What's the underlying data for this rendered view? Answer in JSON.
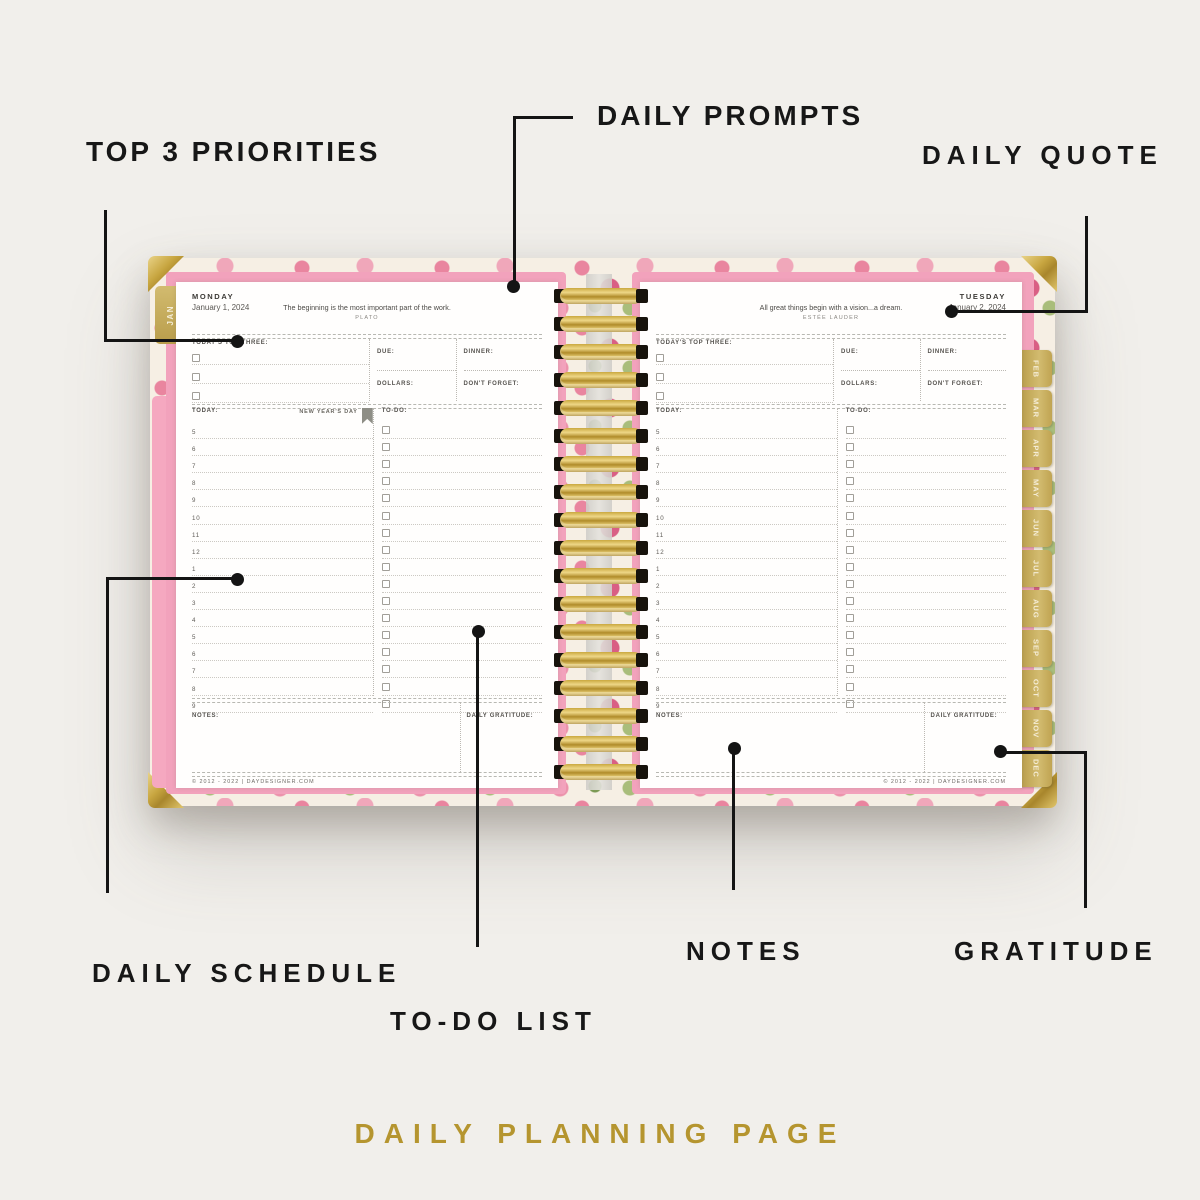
{
  "colors": {
    "background": "#f1efeb",
    "accent_gold": "#b5952f",
    "cover_pink": "#f2a2bc",
    "label_black": "#171717"
  },
  "annotations": {
    "top_priorities": "TOP 3 PRIORITIES",
    "daily_prompts": "DAILY PROMPTS",
    "daily_quote": "DAILY QUOTE",
    "daily_schedule": "DAILY SCHEDULE",
    "todo_list": "TO-DO LIST",
    "notes": "NOTES",
    "gratitude": "GRATITUDE"
  },
  "caption": "DAILY PLANNING PAGE",
  "planner": {
    "month_tab_first": "JAN",
    "month_tabs": [
      "FEB",
      "MAR",
      "APR",
      "MAY",
      "JUN",
      "JUL",
      "AUG",
      "SEP",
      "OCT",
      "NOV",
      "DEC"
    ],
    "labels": {
      "top_three": "TODAY'S TOP THREE:",
      "due": "DUE:",
      "dinner": "DINNER:",
      "dollars": "DOLLARS:",
      "dont_forget": "DON'T FORGET:",
      "today": "TODAY:",
      "todo": "TO-DO:",
      "notes": "NOTES:",
      "gratitude": "DAILY GRATITUDE:"
    },
    "schedule_times": [
      "5",
      "6",
      "7",
      "8",
      "9",
      "10",
      "11",
      "12",
      "1",
      "2",
      "3",
      "4",
      "5",
      "6",
      "7",
      "8",
      "9"
    ],
    "copyright": "© 2012 - 2022 | DAYDESIGNER.COM",
    "left_page": {
      "day": "MONDAY",
      "date": "January 1, 2024",
      "quote": "The beginning is the most important part of the work.",
      "quote_author": "PLATO",
      "holiday": "NEW YEAR'S DAY"
    },
    "right_page": {
      "day": "TUESDAY",
      "date": "January 2, 2024",
      "quote": "All great things begin with a vision...a dream.",
      "quote_author": "ESTÉE LAUDER"
    }
  }
}
